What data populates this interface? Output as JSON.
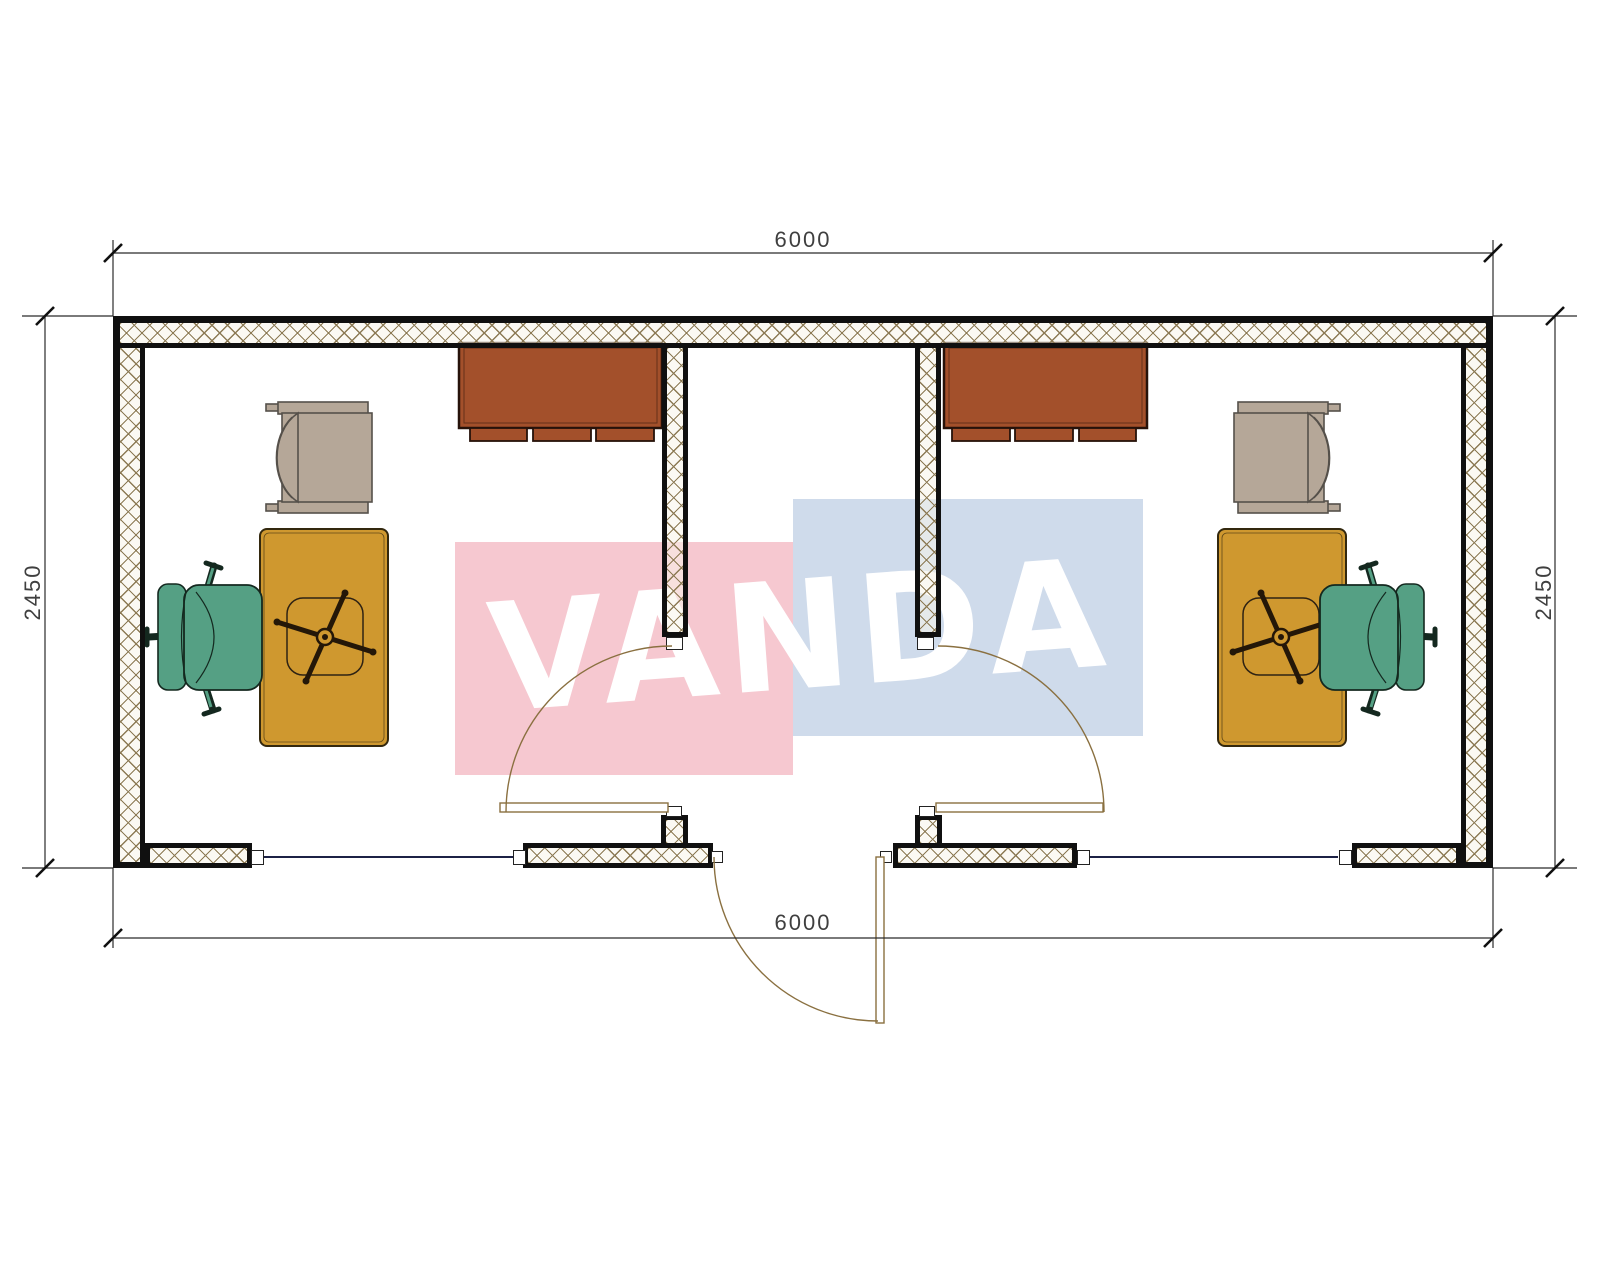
{
  "drawing": {
    "type": "office-container-floor-plan",
    "description": "Plan of a 6000x2450 modular office container with two office rooms and a central entrance vestibule"
  },
  "dimensions": {
    "top": "6000",
    "bottom": "6000",
    "left": "2450",
    "right": "2450"
  },
  "watermark": {
    "text": "VANDA",
    "red_block_color": "#f6c8d0",
    "blue_block_color": "#cfdbeb",
    "text_color": "#ffffff"
  },
  "colors": {
    "wall-line": "#101010",
    "hatch-line": "#8c7a54",
    "desk": "#cf982f",
    "desk-line": "#33280e",
    "chair": "#55a084",
    "chair-line": "#14281f",
    "cabinet": "#a3502b",
    "cabinet-line": "#26120a",
    "armchair": "#b5a798",
    "armchair-line": "#55504a",
    "door-line": "#8a7040",
    "window-line": "#1c2145",
    "dim-line": "#2b2b2b",
    "dim-text": "#3f3f3f",
    "wm-red": "#f6c8d0",
    "wm-blue": "#cfdbeb"
  },
  "furniture": {
    "left_room": [
      "wall-cabinet",
      "armchair",
      "desk",
      "task-chair"
    ],
    "right_room": [
      "wall-cabinet",
      "armchair",
      "desk",
      "task-chair"
    ]
  },
  "openings": [
    "window-left",
    "entrance-door",
    "window-right",
    "room-door-left",
    "room-door-right"
  ]
}
